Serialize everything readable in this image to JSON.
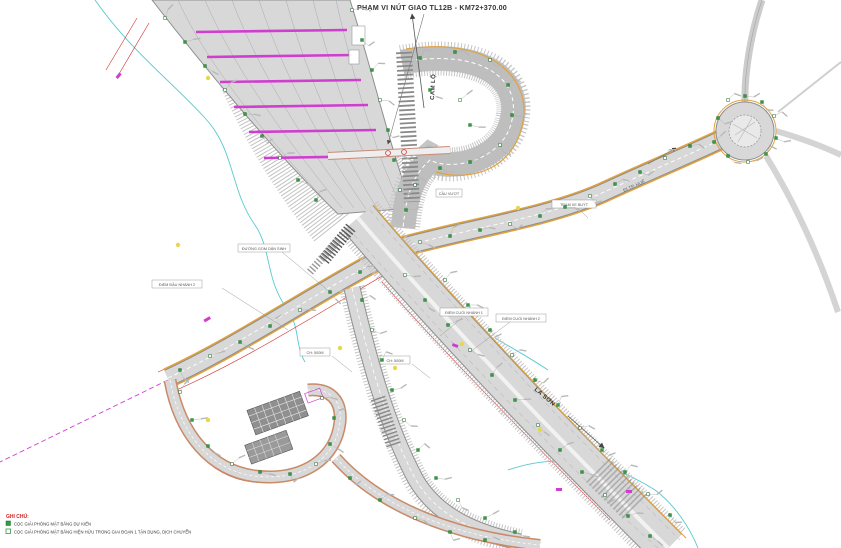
{
  "title": {
    "text": "PHẠM VI NÚT GIAO TL12B - KM72+370.00"
  },
  "directions": {
    "north_label": "CAM LỘ",
    "south_label": "LA SƠN",
    "east_label": "ĐI TP. HUẾ"
  },
  "labels": {
    "duong_gom": "ĐƯỜNG GOM DÂN SINH",
    "diem_dau_nhanh_2": "ĐIỂM ĐẦU NHÁNH 2",
    "diem_cuoi_nhanh_1": "ĐIỂM CUỐI NHÁNH 1",
    "diem_cuoi_nhanh_2": "ĐIỂM CUỐI NHÁNH 2",
    "ch_500_a": "CH: 500M",
    "ch_500_b": "CH: 500M",
    "tram_xe": "TRẠM XE BUÝT",
    "cau_vuot": "CẦU VƯỢT"
  },
  "legend": {
    "heading": "GHI CHÚ:",
    "items": [
      {
        "swatch": "green-filled",
        "label": "CỌC GIẢI PHÓNG MẶT BẰNG DỰ KIẾN"
      },
      {
        "swatch": "green-open",
        "label": "CỌC GIẢI PHÓNG MẶT BẰNG HIỆN HỮU TRONG GIAI ĐOẠN 1 TẬN DỤNG, DỊCH CHUYỂN"
      }
    ]
  },
  "colors": {
    "road_fill": "#d8d8d8",
    "road_casing": "#8f8f8f",
    "edge_orange": "#e0a23e",
    "row_red": "#cf3333",
    "magenta": "#cf3ecf",
    "stream_cyan": "#57c8cf",
    "marker_green": "#2f9e41",
    "dot_yellow": "#e6d84d"
  }
}
